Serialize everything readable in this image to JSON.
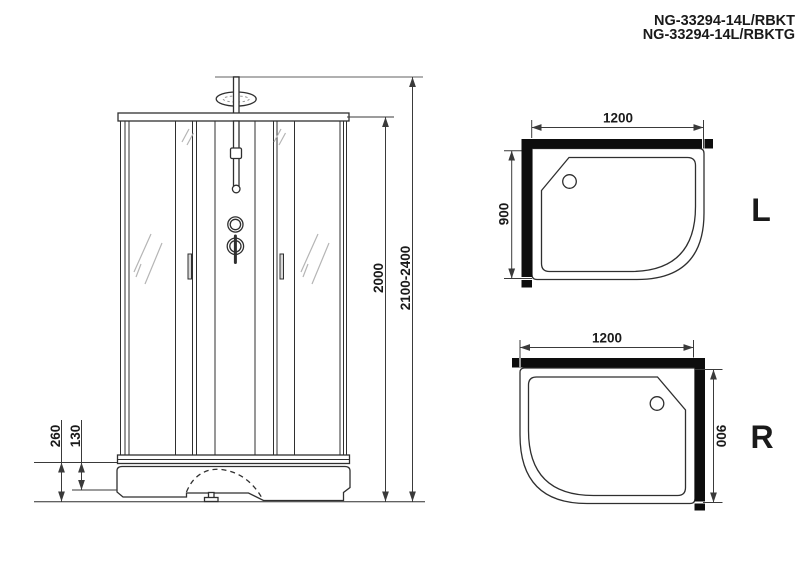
{
  "title": {
    "line1": "NG-33294-14L/RBKT",
    "line2": "NG-33294-14L/RBKTG"
  },
  "front_view": {
    "dim_cabin_height": "2000",
    "dim_total_height": "2100-2400",
    "dim_base_height": "260",
    "dim_tray_height": "130"
  },
  "top_view_l": {
    "dim_width": "1200",
    "dim_depth": "900",
    "label": "L"
  },
  "top_view_r": {
    "dim_width": "1200",
    "dim_depth": "900",
    "label": "R"
  },
  "colors": {
    "background": "#ffffff",
    "line": "#2f2f2f",
    "dim": "#3a3a3a",
    "wall": "#0d0d0d",
    "glass_hatch": "#b5b5b5",
    "reference": "#b0b0b0",
    "text": "#1a1a1a"
  }
}
